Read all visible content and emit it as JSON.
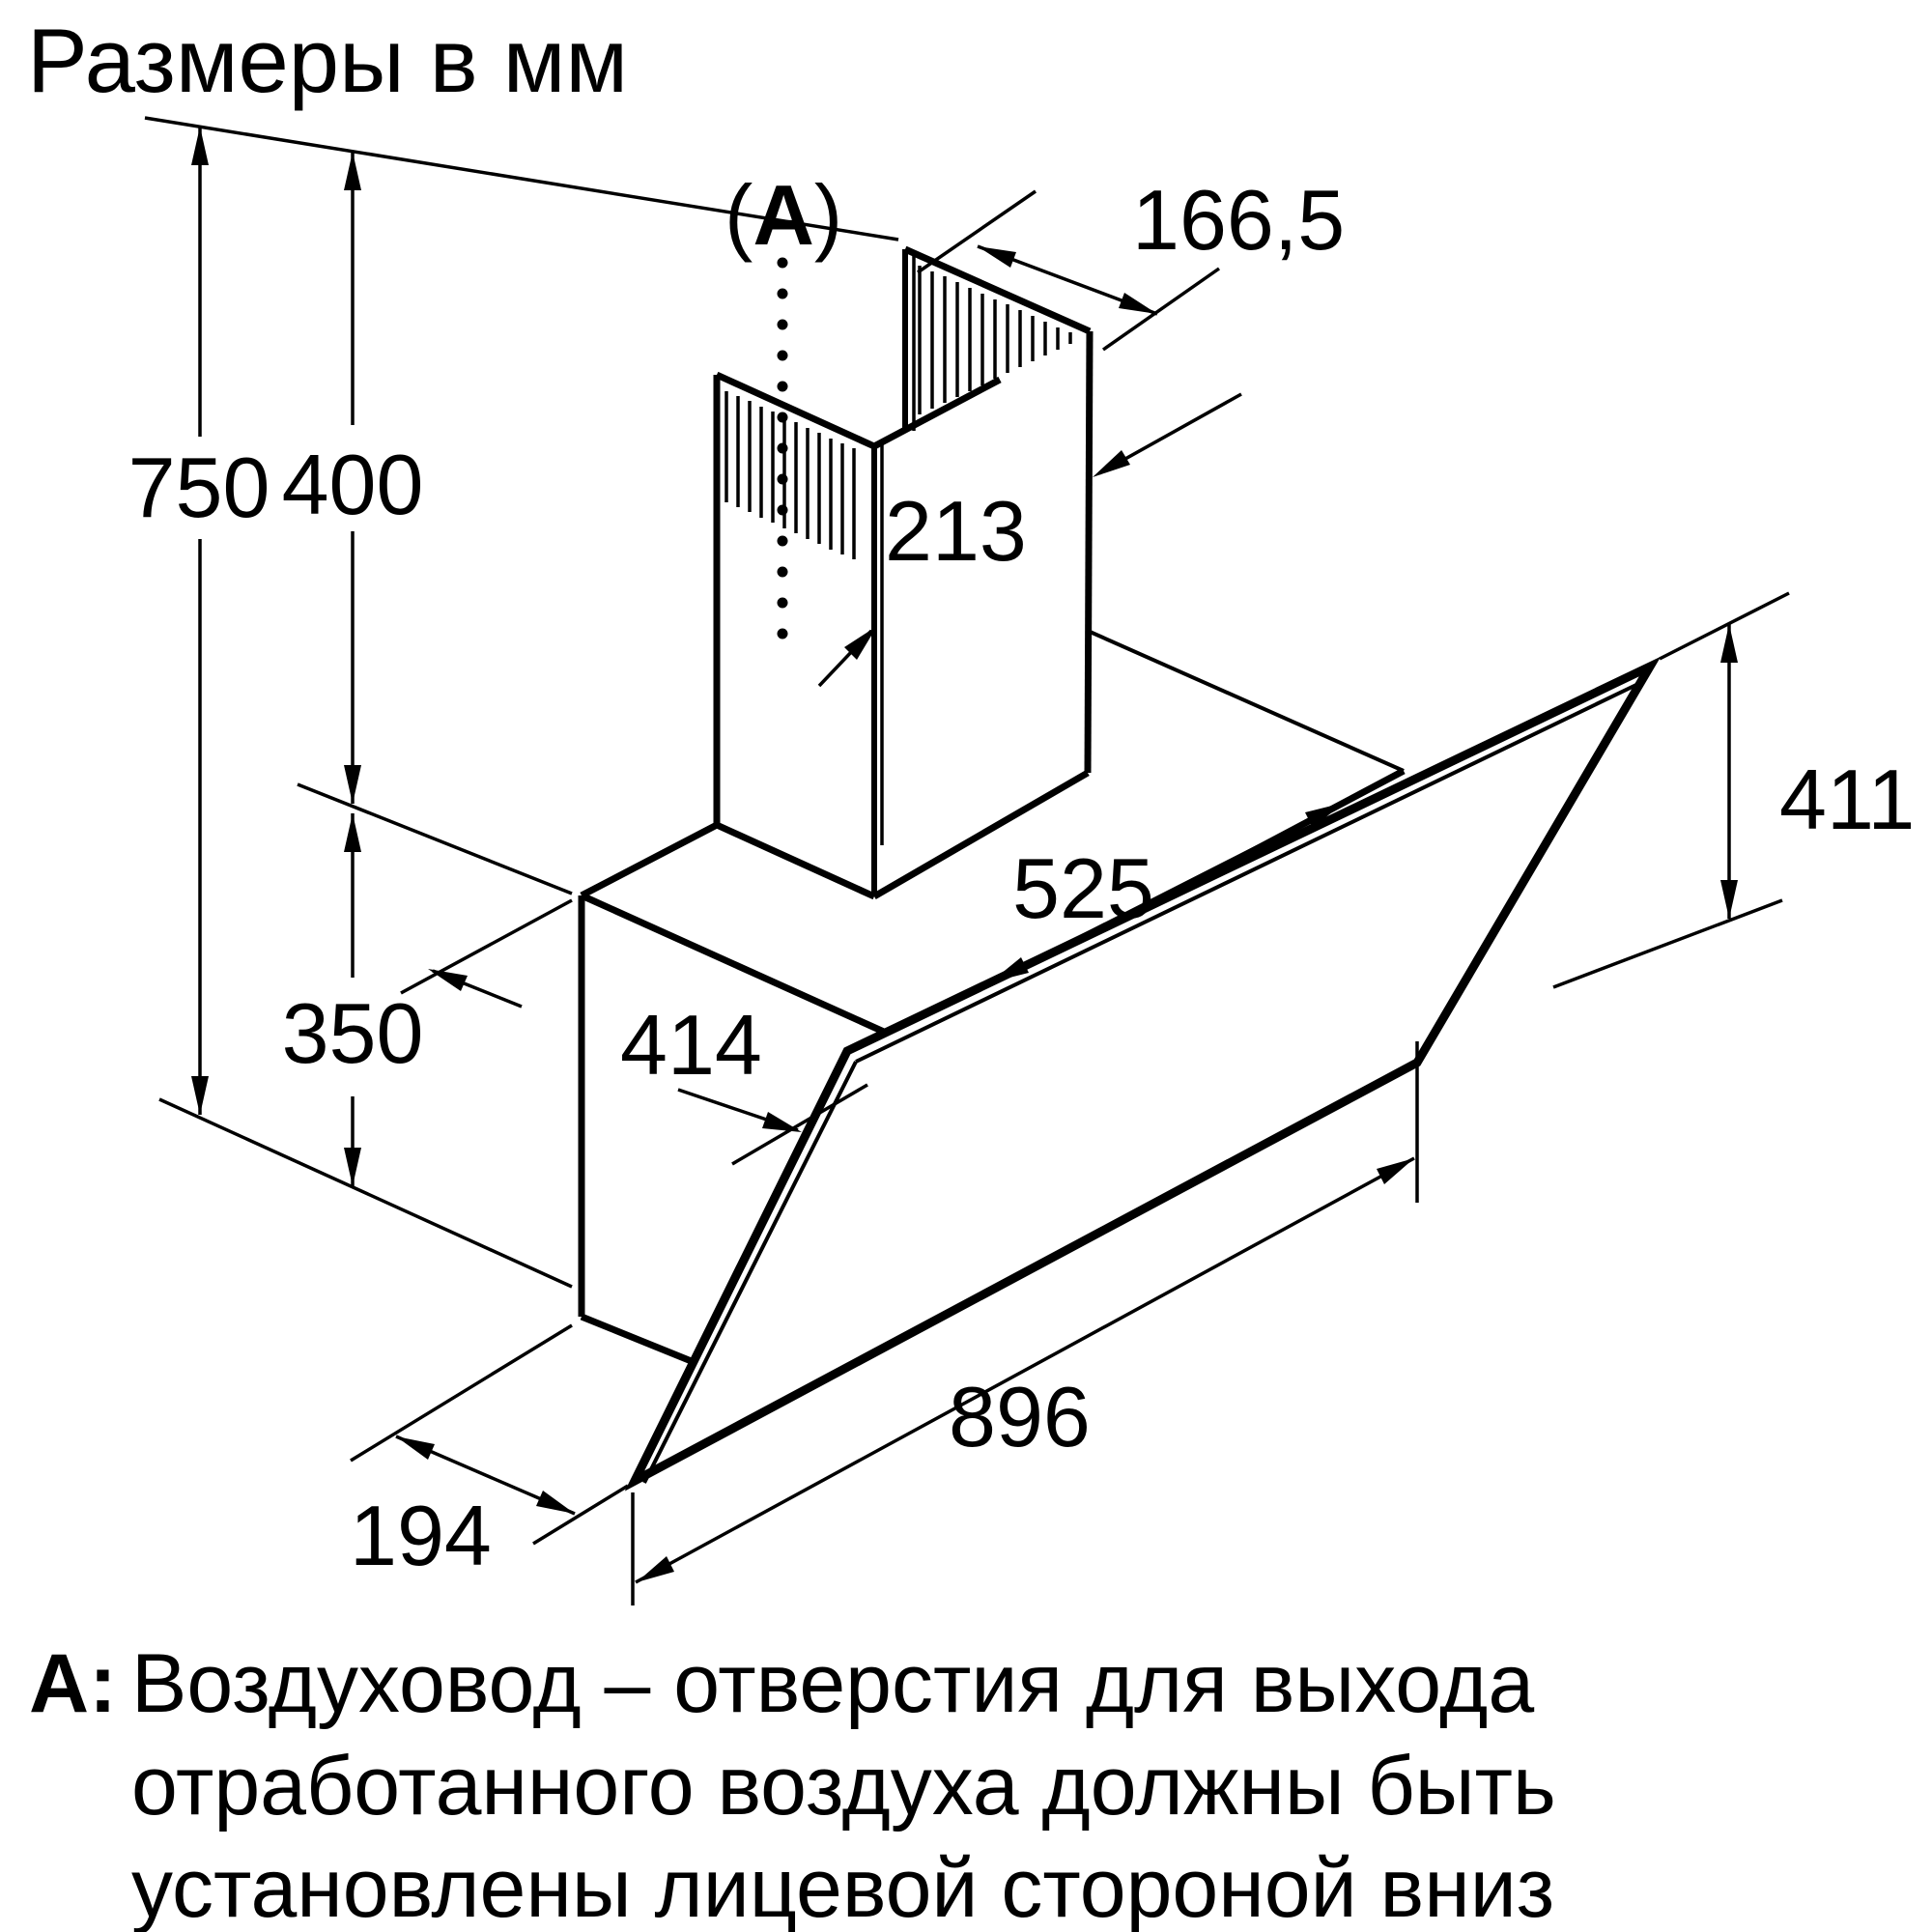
{
  "title": "Размеры в мм",
  "callout": {
    "open": "(",
    "letter": "A",
    "close": ")"
  },
  "dimensions": {
    "duct_top_depth": "166,5",
    "chimney_height": "400",
    "total_height": "750",
    "chimney_depth": "213",
    "body_top_width": "525",
    "glass_side_height": "411",
    "body_top_depth": "414",
    "body_height": "350",
    "glass_width": "896",
    "bottom_depth": "194"
  },
  "footnote": {
    "prefix": "A:",
    "line1": "Воздуховод – отверстия для выхода",
    "line2": "отработанного воздуха должны быть",
    "line3": "установлены лицевой стороной вниз"
  },
  "colors": {
    "line": "#000000",
    "background": "#ffffff"
  }
}
